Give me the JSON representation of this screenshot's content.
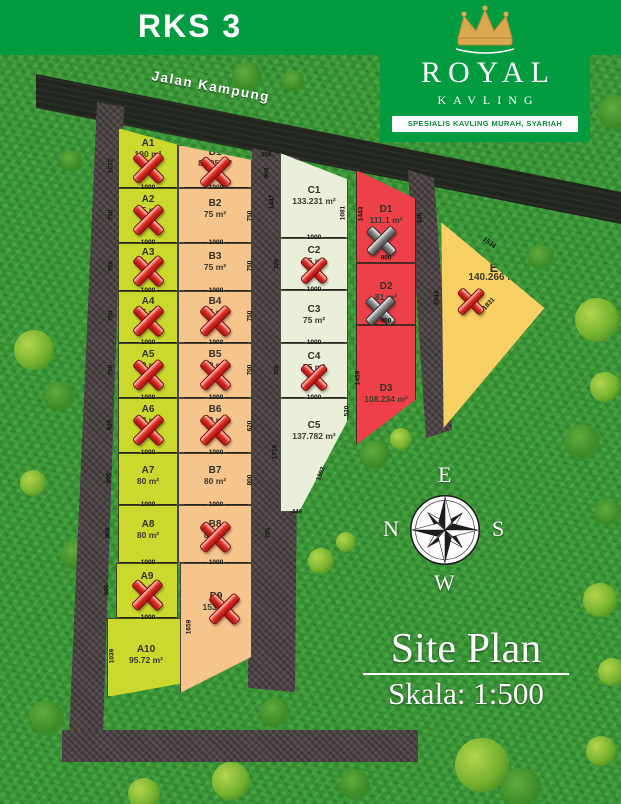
{
  "title": "RKS 3",
  "brand": {
    "name_top": "ROYAL",
    "name_bottom": "KAVLING",
    "tagline": "SPESIALIS KAVLING MURAH, SYARIAH",
    "crown_color": "#d9a84f",
    "banner_color": "#029b40"
  },
  "road_label": "Jalan Kampung",
  "site_plan": {
    "title": "Site Plan",
    "scale": "Skala: 1:500"
  },
  "compass": {
    "top": "E",
    "left": "N",
    "right": "S",
    "bottom": "W"
  },
  "lot_width_label": "1000",
  "legend_colors": {
    "row_a": "#cbd92e",
    "row_b": "#f6c48d",
    "row_c": "#e9efd9",
    "row_d": "#ee4048",
    "plot_e": "#f8d063",
    "road": "#4e4546",
    "sold_x": "#c01616"
  },
  "plots": [
    {
      "id": "A1",
      "area": "100 m²",
      "status": "sold-red"
    },
    {
      "id": "A2",
      "area": "75 m²",
      "status": "sold-red"
    },
    {
      "id": "A3",
      "area": "78 m²",
      "status": "sold-red"
    },
    {
      "id": "A4",
      "area": "75 m²",
      "status": "sold-red"
    },
    {
      "id": "A5",
      "area": "70 m²",
      "status": "sold-red"
    },
    {
      "id": "A6",
      "area": "92 m²",
      "status": "sold-red"
    },
    {
      "id": "A7",
      "area": "80 m²",
      "status": "available"
    },
    {
      "id": "A8",
      "area": "80 m²",
      "status": "available"
    },
    {
      "id": "A9",
      "area": "80 m²",
      "status": "sold-red"
    },
    {
      "id": "A10",
      "area": "95.72 m²",
      "status": "available"
    },
    {
      "id": "B1",
      "area": "87.05 m²",
      "status": "sold-red"
    },
    {
      "id": "B2",
      "area": "75 m²",
      "status": "available"
    },
    {
      "id": "B3",
      "area": "75 m²",
      "status": "available"
    },
    {
      "id": "B4",
      "area": "75 m²",
      "status": "sold-red"
    },
    {
      "id": "B5",
      "area": "70 m²",
      "status": "sold-red"
    },
    {
      "id": "B6",
      "area": "92 m²",
      "status": "sold-red"
    },
    {
      "id": "B7",
      "area": "80 m²",
      "status": "available"
    },
    {
      "id": "B8",
      "area": "80 m²",
      "status": "sold-red"
    },
    {
      "id": "B9",
      "area": "153 m²",
      "status": "sold-red"
    },
    {
      "id": "C1",
      "area": "133.231 m²",
      "status": "available"
    },
    {
      "id": "C2",
      "area": "75 m²",
      "status": "sold-red"
    },
    {
      "id": "C3",
      "area": "75 m²",
      "status": "available"
    },
    {
      "id": "C4",
      "area": "75 m²",
      "status": "sold-red"
    },
    {
      "id": "C5",
      "area": "137.782 m²",
      "status": "available"
    },
    {
      "id": "D1",
      "area": "111.1 m²",
      "status": "sold-gray"
    },
    {
      "id": "D2",
      "area": "81 m²",
      "status": "sold-gray"
    },
    {
      "id": "D3",
      "area": "108.234 m²",
      "status": "available"
    },
    {
      "id": "E",
      "area": "140.266 m²",
      "status": "sold-red"
    }
  ],
  "dimensions": [
    {
      "v": "1072",
      "edge": "A1-left"
    },
    {
      "v": "750",
      "edge": "A2-left"
    },
    {
      "v": "780",
      "edge": "A3-left"
    },
    {
      "v": "750",
      "edge": "A4-left"
    },
    {
      "v": "700",
      "edge": "A5-left"
    },
    {
      "v": "920",
      "edge": "A6-left"
    },
    {
      "v": "800",
      "edge": "A7-left"
    },
    {
      "v": "800",
      "edge": "A8-left"
    },
    {
      "v": "800",
      "edge": "A9-left"
    },
    {
      "v": "1039",
      "edge": "A10-left"
    },
    {
      "v": "1659",
      "edge": "B9-left"
    },
    {
      "v": "300",
      "edge": "road-top"
    },
    {
      "v": "900",
      "edge": "B1-right"
    },
    {
      "v": "1447",
      "edge": "C1-left"
    },
    {
      "v": "750",
      "edge": "B2-right"
    },
    {
      "v": "750",
      "edge": "B3-right"
    },
    {
      "v": "720",
      "edge": "C2-left"
    },
    {
      "v": "750",
      "edge": "B4-right"
    },
    {
      "v": "700",
      "edge": "B5-right"
    },
    {
      "v": "700",
      "edge": "C4-left"
    },
    {
      "v": "620",
      "edge": "B6-right"
    },
    {
      "v": "800",
      "edge": "B7-right"
    },
    {
      "v": "1718",
      "edge": "C5-left"
    },
    {
      "v": "765",
      "edge": "road-middle-bottom"
    },
    {
      "v": "1081",
      "edge": "C1-right"
    },
    {
      "v": "1443",
      "edge": "D1-left"
    },
    {
      "v": "900",
      "edge": "D1-bottom"
    },
    {
      "v": "800",
      "edge": "D2-bottom"
    },
    {
      "v": "1459",
      "edge": "D3-left"
    },
    {
      "v": "520",
      "edge": "C5-right"
    },
    {
      "v": "1302",
      "edge": "C5-diagonal"
    },
    {
      "v": "446",
      "edge": "C5-bottom"
    },
    {
      "v": "430",
      "edge": "road-right-top"
    },
    {
      "v": "2044",
      "edge": "road-right"
    },
    {
      "v": "1534",
      "edge": "E-top"
    },
    {
      "v": "1831",
      "edge": "E-bottom"
    }
  ]
}
